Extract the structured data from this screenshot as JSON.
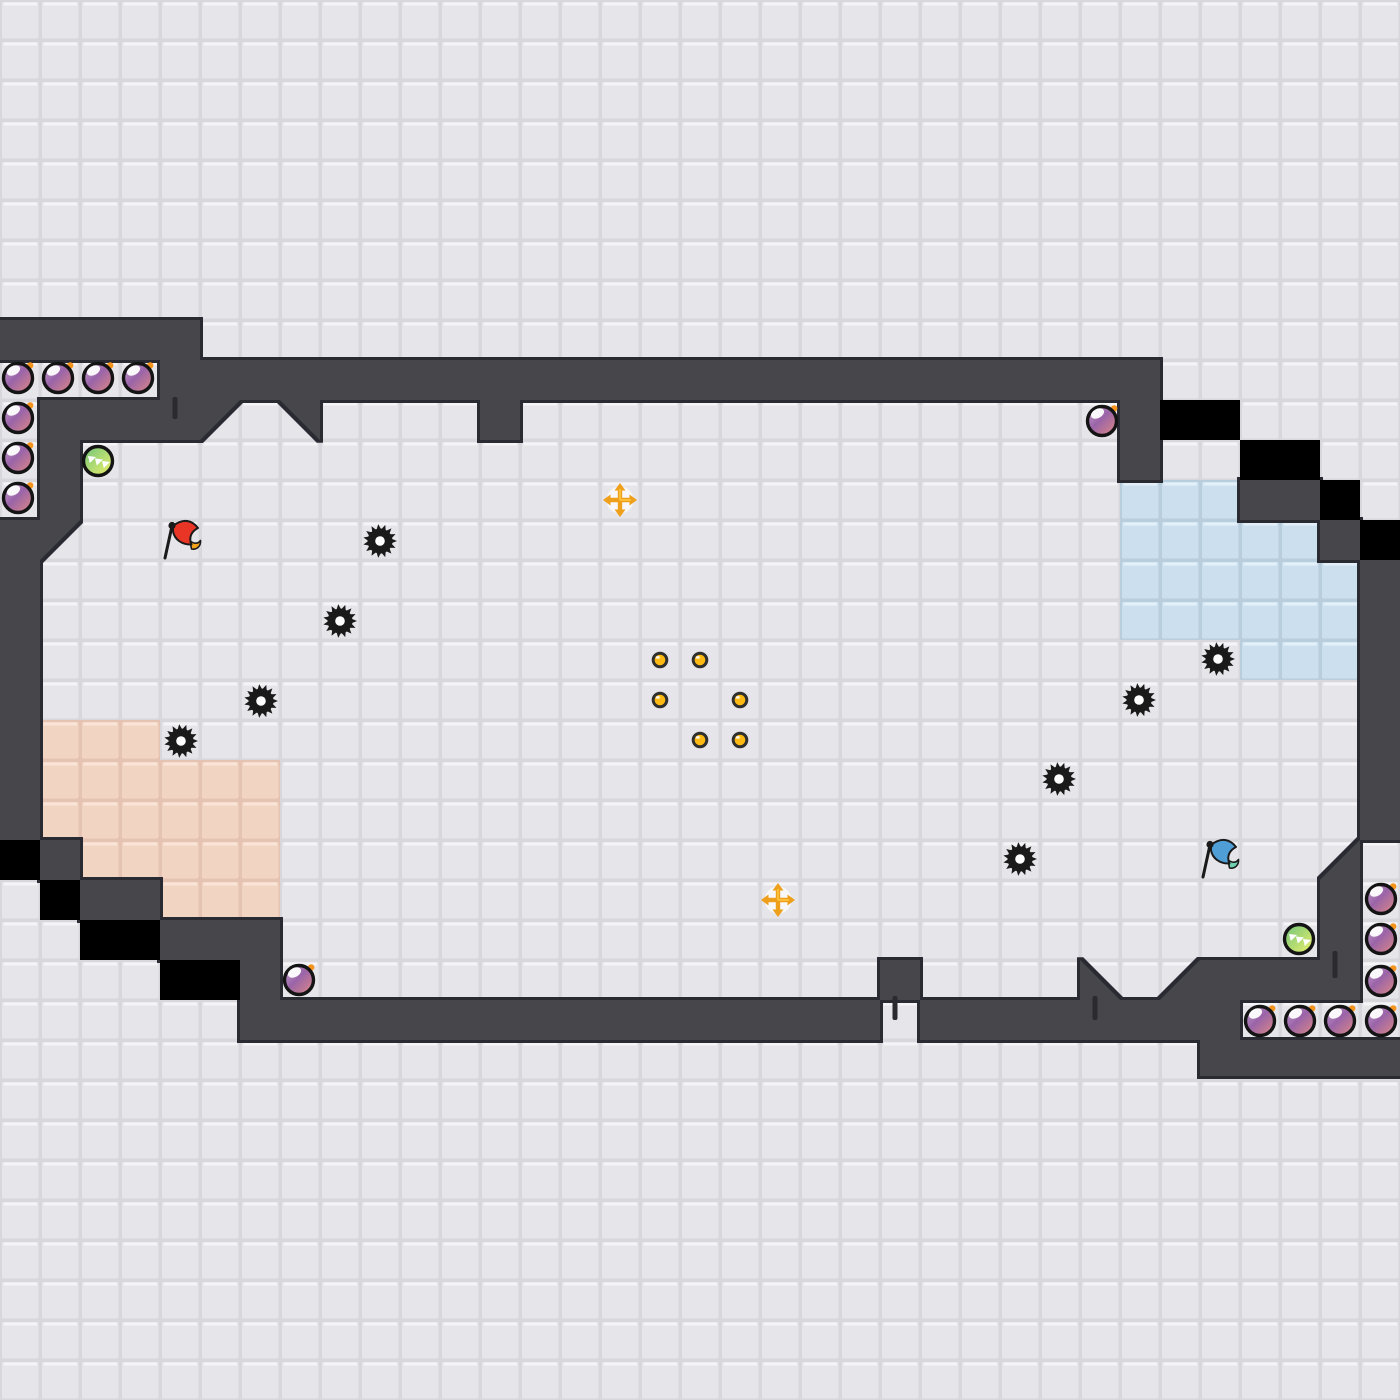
{
  "meta": {
    "scene": "tile-grid platformer level map",
    "canvas_width": 1400,
    "canvas_height": 1400,
    "cell_size": 40
  },
  "palette": {
    "grid_gap": "#d8d7dc",
    "grid_tile": "#e6e5e9",
    "grid_bevel": "#f5f4f7",
    "wall": "#47474c",
    "wall_outline": "#2b2b30",
    "black_cell": "#000000",
    "pink_gap": "#e5c3b2",
    "pink_tile": "#f2d4c3",
    "pink_bevel": "#f9e4d7",
    "blue_gap": "#b8cedd",
    "blue_tile": "#ccdfee",
    "blue_bevel": "#e3f0f9",
    "bomb_top": "#c9a6cf",
    "bomb_mid": "#9a64a8",
    "bomb_bottom": "#e08a84",
    "bomb_ring": "#141414",
    "bomb_fuse": "#f7941d",
    "orb_green": "#6fc47c",
    "orb_yellow": "#eef06a",
    "gear": "#1a1a1a",
    "gear_hole": "#ffffff",
    "coin_fill": "#fcba12",
    "coin_ring": "#30302c",
    "pad_cross": "#ee9f1c",
    "pad_cross_light": "#ffc63f",
    "pad_disc": "#fdfdfe",
    "flag_red": "#e93526",
    "flag_red_tail": "#f6a31c",
    "flag_blue": "#4f9fd6",
    "flag_blue_tail": "#6fd0b0",
    "flag_pole": "#1a1a1a",
    "door_bar": "#2a2a2f"
  },
  "terrain": {
    "wall_rects": [
      [
        0,
        320,
        200,
        40
      ],
      [
        160,
        360,
        40,
        40
      ],
      [
        200,
        360,
        960,
        40
      ],
      [
        40,
        400,
        160,
        40
      ],
      [
        480,
        400,
        40,
        40
      ],
      [
        1120,
        400,
        40,
        80
      ],
      [
        1240,
        480,
        80,
        40
      ],
      [
        1320,
        520,
        40,
        40
      ],
      [
        1360,
        560,
        40,
        280
      ],
      [
        1320,
        880,
        40,
        120
      ],
      [
        1200,
        960,
        160,
        40
      ],
      [
        1120,
        1000,
        120,
        40
      ],
      [
        1200,
        1040,
        200,
        36
      ],
      [
        240,
        1000,
        640,
        40
      ],
      [
        920,
        1000,
        200,
        40
      ],
      [
        880,
        960,
        40,
        40
      ],
      [
        40,
        840,
        40,
        40
      ],
      [
        80,
        880,
        80,
        40
      ],
      [
        160,
        920,
        120,
        40
      ],
      [
        240,
        960,
        40,
        40
      ],
      [
        40,
        440,
        40,
        80
      ]
    ],
    "wall_polys": [
      [
        [
          200,
          400
        ],
        [
          240,
          400
        ],
        [
          200,
          440
        ]
      ],
      [
        [
          280,
          400
        ],
        [
          320,
          400
        ],
        [
          320,
          440
        ]
      ],
      [
        [
          1360,
          840
        ],
        [
          1360,
          880
        ],
        [
          1320,
          880
        ]
      ],
      [
        [
          1200,
          960
        ],
        [
          1200,
          1000
        ],
        [
          1160,
          1000
        ]
      ],
      [
        [
          1080,
          960
        ],
        [
          1120,
          1000
        ],
        [
          1080,
          1000
        ]
      ],
      [
        [
          0,
          520
        ],
        [
          80,
          520
        ],
        [
          40,
          560
        ],
        [
          40,
          840
        ],
        [
          0,
          840
        ]
      ]
    ],
    "black_cells": [
      [
        1160,
        400
      ],
      [
        1200,
        400
      ],
      [
        1240,
        440
      ],
      [
        1280,
        440
      ],
      [
        1320,
        480
      ],
      [
        1360,
        520
      ],
      [
        0,
        840
      ],
      [
        40,
        880
      ],
      [
        80,
        920
      ],
      [
        120,
        920
      ],
      [
        160,
        960
      ],
      [
        200,
        960
      ]
    ],
    "pink_cells": [
      [
        40,
        720
      ],
      [
        80,
        720
      ],
      [
        120,
        720
      ],
      [
        40,
        760
      ],
      [
        80,
        760
      ],
      [
        120,
        760
      ],
      [
        160,
        760
      ],
      [
        200,
        760
      ],
      [
        240,
        760
      ],
      [
        40,
        800
      ],
      [
        80,
        800
      ],
      [
        120,
        800
      ],
      [
        160,
        800
      ],
      [
        200,
        800
      ],
      [
        240,
        800
      ],
      [
        80,
        840
      ],
      [
        120,
        840
      ],
      [
        160,
        840
      ],
      [
        200,
        840
      ],
      [
        240,
        840
      ],
      [
        160,
        880
      ],
      [
        200,
        880
      ],
      [
        240,
        880
      ]
    ],
    "blue_cells": [
      [
        1120,
        480
      ],
      [
        1160,
        480
      ],
      [
        1200,
        480
      ],
      [
        1120,
        520
      ],
      [
        1160,
        520
      ],
      [
        1200,
        520
      ],
      [
        1240,
        520
      ],
      [
        1280,
        520
      ],
      [
        1120,
        560
      ],
      [
        1160,
        560
      ],
      [
        1200,
        560
      ],
      [
        1240,
        560
      ],
      [
        1280,
        560
      ],
      [
        1320,
        560
      ],
      [
        1120,
        600
      ],
      [
        1160,
        600
      ],
      [
        1200,
        600
      ],
      [
        1240,
        600
      ],
      [
        1280,
        600
      ],
      [
        1320,
        600
      ],
      [
        1240,
        640
      ],
      [
        1280,
        640
      ],
      [
        1320,
        640
      ]
    ]
  },
  "entities": {
    "bombs": [
      [
        18,
        378
      ],
      [
        58,
        378
      ],
      [
        98,
        378
      ],
      [
        138,
        378
      ],
      [
        18,
        418
      ],
      [
        18,
        458
      ],
      [
        18,
        498
      ],
      [
        1102,
        421
      ],
      [
        299,
        980
      ],
      [
        1381,
        899
      ],
      [
        1381,
        939
      ],
      [
        1381,
        981
      ],
      [
        1260,
        1021
      ],
      [
        1300,
        1021
      ],
      [
        1340,
        1021
      ],
      [
        1381,
        1021
      ]
    ],
    "green_orbs": [
      [
        98,
        461
      ],
      [
        1299,
        939
      ]
    ],
    "gears": [
      [
        380,
        541
      ],
      [
        340,
        621
      ],
      [
        261,
        701
      ],
      [
        181,
        741
      ],
      [
        1218,
        659
      ],
      [
        1139,
        700
      ],
      [
        1059,
        779
      ],
      [
        1020,
        859
      ]
    ],
    "coins": [
      [
        660,
        660
      ],
      [
        700,
        660
      ],
      [
        660,
        700
      ],
      [
        740,
        700
      ],
      [
        700,
        740
      ],
      [
        740,
        740
      ]
    ],
    "launch_pads": [
      [
        620,
        500
      ],
      [
        778,
        900
      ]
    ],
    "flags": [
      {
        "color_name": "red",
        "x": 165,
        "y": 558
      },
      {
        "color_name": "blue",
        "x": 1203,
        "y": 877
      }
    ],
    "door_bars": [
      {
        "x": 175,
        "y": 397,
        "h": 22
      },
      {
        "x": 895,
        "y": 996,
        "h": 24
      },
      {
        "x": 1095,
        "y": 996,
        "h": 24
      },
      {
        "x": 1335,
        "y": 951,
        "h": 27
      }
    ]
  }
}
